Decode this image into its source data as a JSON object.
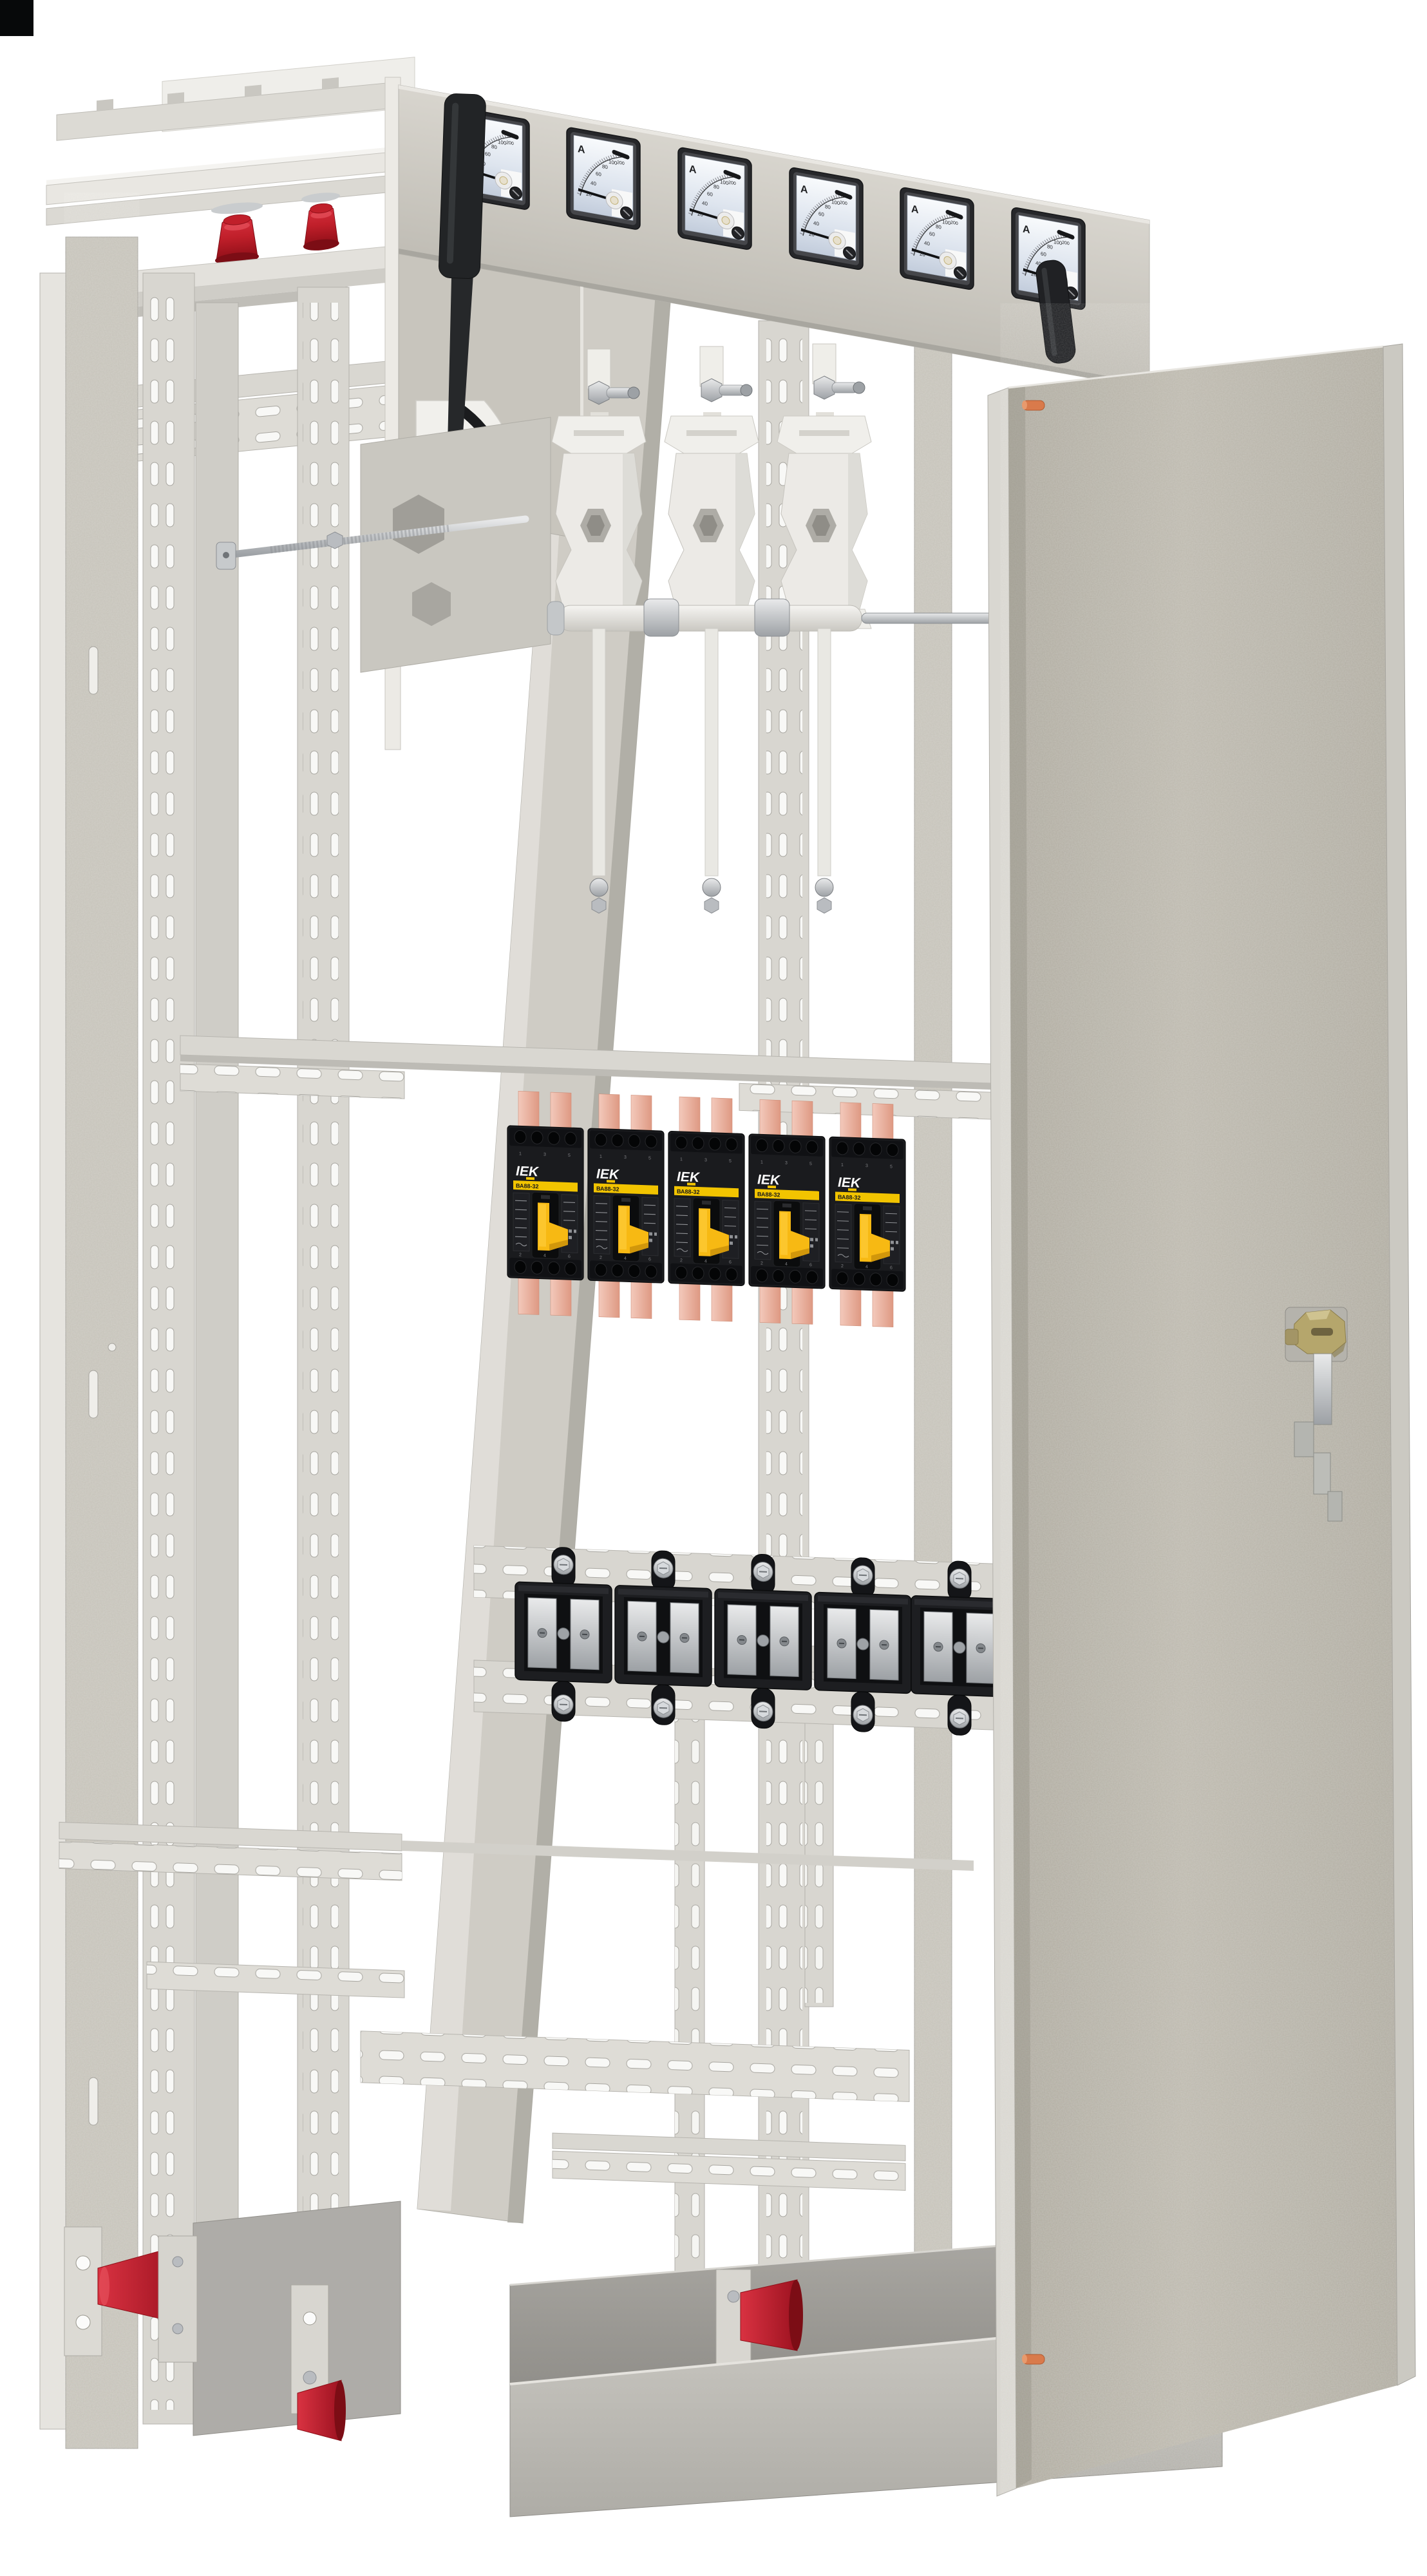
{
  "scene": {
    "background": "#ffffff",
    "corner_marker_color": "#07090a"
  },
  "instrument_panel": {
    "meter_count": 6,
    "unit_label": "A",
    "scale_ticks": [
      "20",
      "40",
      "60",
      "80",
      "100",
      "200"
    ]
  },
  "breaker_row": {
    "count": 5,
    "brand": "IEK",
    "model": "ВА88-32",
    "top_terminals": [
      "1",
      "3",
      "5"
    ],
    "bottom_terminals": [
      "2",
      "4",
      "6"
    ],
    "test_button_label": "T"
  },
  "terminal_row": {
    "count": 5
  },
  "switch_assembly": {
    "pole_count": 3
  },
  "colors": {
    "cabinet_body": "#c8c5bc",
    "rail": "#dcdad4",
    "door_inner": "#b8b4a9",
    "breaker_body": "#17181a",
    "breaker_stripe": "#f2c400",
    "breaker_handle": "#f7b913",
    "copper_busbar": "#eec0b2",
    "insulator_red": "#c01f2a",
    "lock_brass": "#b5a66c",
    "door_pin_copper": "#d97a4b"
  }
}
